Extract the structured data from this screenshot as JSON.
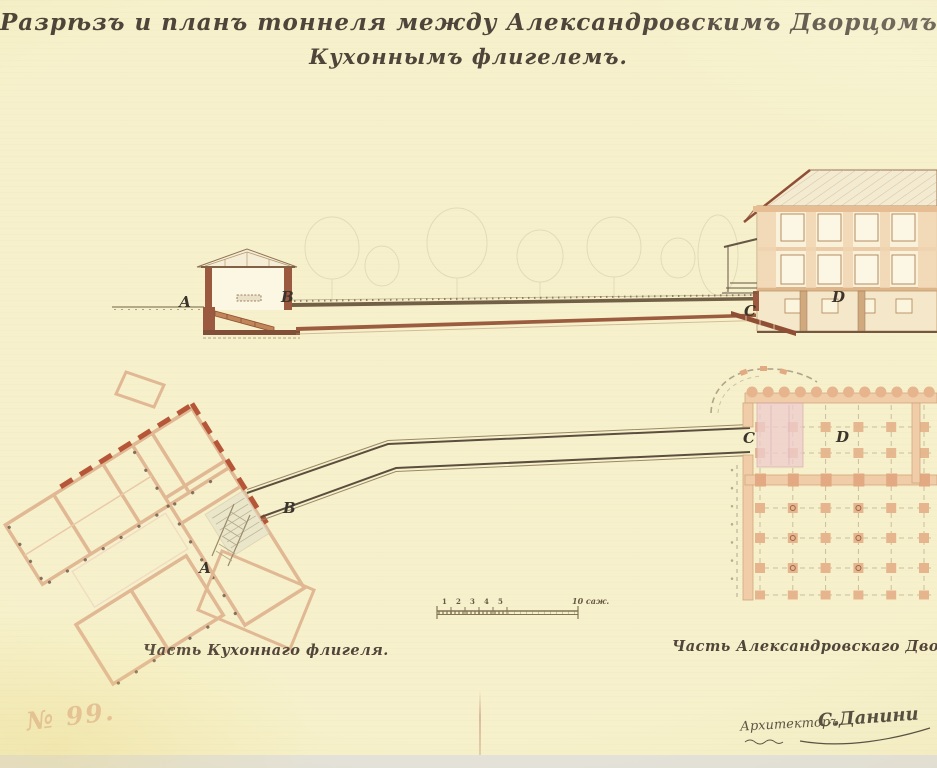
{
  "title": {
    "line1": "Разрѣзъ и планъ тоннеля между Александровскимъ Дворцомъ и",
    "line2": "Кухоннымъ флигелемъ."
  },
  "section_view": {
    "description": "cross-section of tunnel from kitchen pavilion to palace basement",
    "labels": {
      "a": "А",
      "b": "В",
      "c": "С",
      "d": "D"
    }
  },
  "plan_view": {
    "labels": {
      "a": "А",
      "b": "В",
      "c": "С",
      "d": "D"
    },
    "caption_left": "Часть Кухоннаго флигеля.",
    "caption_right": "Часть Александровскаго Дворца."
  },
  "scale_bar": {
    "numbers": [
      "1",
      "2",
      "3",
      "4",
      "5"
    ],
    "label": "10 саж."
  },
  "footer": {
    "stamp": "№ 99.",
    "architect_title": "Архитекторъ",
    "architect_name": "С.Данини"
  },
  "colors": {
    "paper": "#f5efc5",
    "ink": "#2a1f14",
    "wall_red": "#8a3c20",
    "wall_salmon": "#dcab84",
    "accent_red": "#a83818",
    "tunnel_dark": "#4a3828",
    "pencil": "#c9c0a2",
    "stamp_pink": "#ca7c5e",
    "pink_hall": "#ecc3c8"
  }
}
